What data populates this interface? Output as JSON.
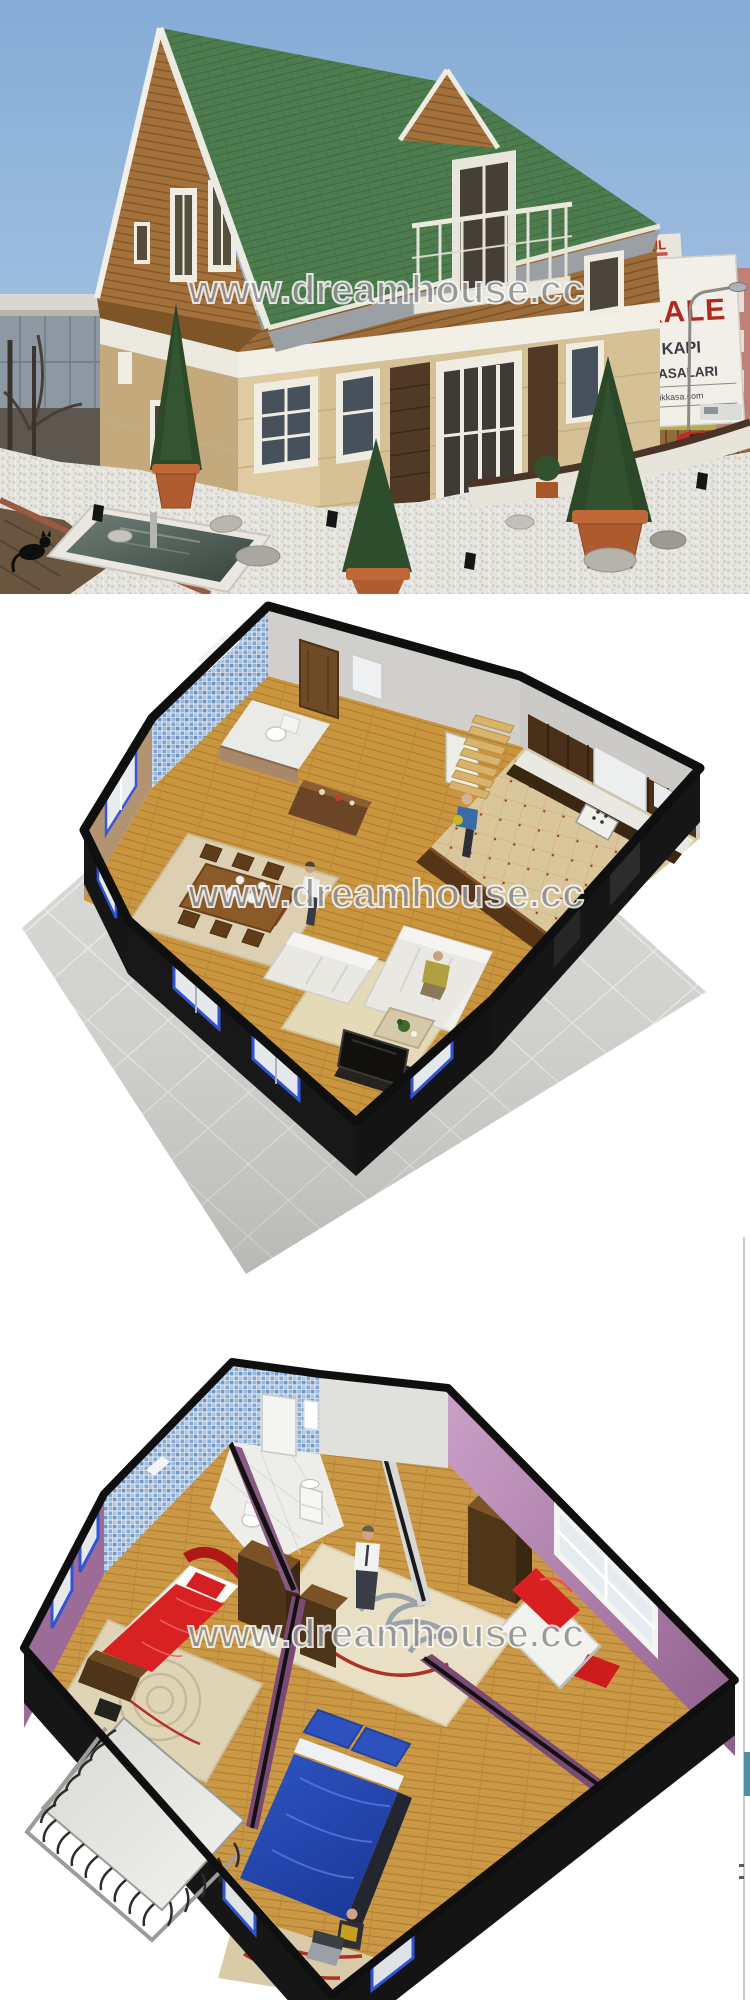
{
  "exterior": {
    "watermark": "www.dreamhouse.cc",
    "billboard": {
      "roof_sign": "ERDİL",
      "brand": "KALE",
      "line1": "ÇELİK KAPI",
      "line2": "PARA KASALARI",
      "website": "www.kalecelikkasa.com"
    },
    "colors": {
      "sky": "#8fb4da",
      "roof_green": "#4d7c4e",
      "wood_siding": "#9c6d3a",
      "lower_wall": "#d6c096",
      "billboard_red": "#b2281e",
      "pool_water": "#4d5c54"
    }
  },
  "ground_floor": {
    "watermark": "www.dreamhouse.cc",
    "colors": {
      "tile_base": "#d7d7d4",
      "walls": "#141414",
      "wood_floor": "#c9953f",
      "mosaic": "#7fa3cc",
      "cabinets": "#4a3018",
      "sofa_white": "#e9e8e2"
    }
  },
  "upper_floor": {
    "watermark": "www.dreamhouse.cc",
    "colors": {
      "purple_wall": "#9c6c97",
      "pink_wall": "#c795c2",
      "mosaic": "#7fa3cc",
      "bed_red": "#d82222",
      "bed_blue": "#2e55c4",
      "wood_floor": "#cb9846"
    }
  }
}
